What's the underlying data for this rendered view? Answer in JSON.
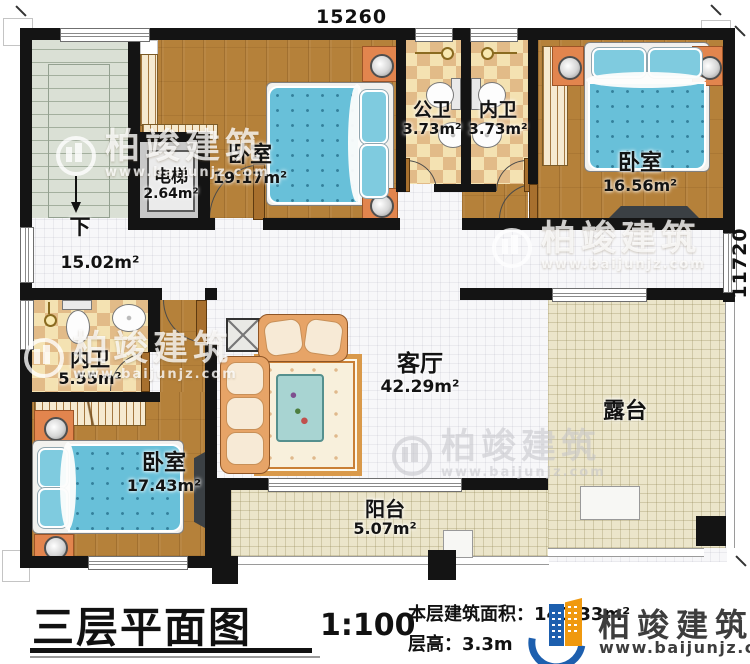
{
  "plan": {
    "dim_top": "15260",
    "dim_right": "11720",
    "stairs_down_label": "下",
    "rooms": {
      "bedroom1": {
        "name": "卧室",
        "area": "19.17m²"
      },
      "elevator": {
        "name": "电梯",
        "area": "2.64m²"
      },
      "public_bath": {
        "name": "公卫",
        "area": "3.73m²"
      },
      "ensuite_bath_top": {
        "name": "内卫",
        "area": "3.73m²"
      },
      "bedroom2": {
        "name": "卧室",
        "area": "16.56m²"
      },
      "hallway": {
        "area": "15.02m²"
      },
      "ensuite_bath_mid": {
        "name": "内卫",
        "area": "5.55m²"
      },
      "bedroom3": {
        "name": "卧室",
        "area": "17.43m²"
      },
      "living_room": {
        "name": "客厅",
        "area": "42.29m²"
      },
      "terrace": {
        "name": "露台"
      },
      "balcony": {
        "name": "阳台",
        "area": "5.07m²"
      }
    }
  },
  "title_block": {
    "title": "三层平面图",
    "scale": "1:100",
    "area_label": "本层建筑面积：",
    "area_value": "140.33m²",
    "height_label": "层高：",
    "height_value": "3.3m"
  },
  "branding": {
    "company": "柏竣建筑",
    "website": "www.baijunjz.com"
  },
  "watermark": {
    "company": "柏竣建筑",
    "website": "www.baijunjz.com"
  }
}
